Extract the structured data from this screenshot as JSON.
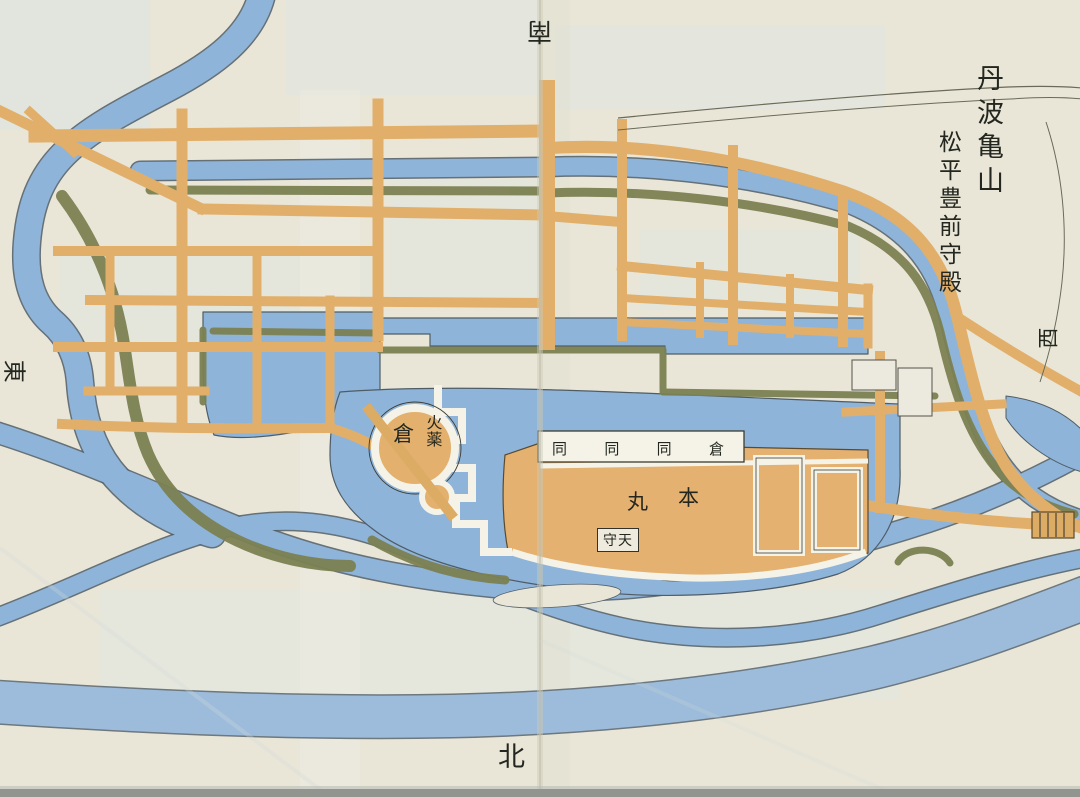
{
  "labels": {
    "title_castle": "丹波亀山",
    "title_lord": "松平豊前守殿",
    "compass_top": "南",
    "compass_bottom": "北",
    "compass_left": "東",
    "compass_right": "西",
    "gunpowder": "火薬",
    "gunpowder_store": "倉",
    "store_row": [
      "同",
      "同",
      "同",
      "倉"
    ],
    "honmaru_char_left": "丸",
    "honmaru_char_right": "本",
    "tenshu": "守天"
  },
  "colors": {
    "paper": "#e9e6d8",
    "water_blue": "#8fb4d9",
    "water_edge_ink": "#4f5c66",
    "road_orange": "#e1af6a",
    "honmaru_orange": "#e5b170",
    "embankment_olive": "#7c8152",
    "wall_white": "#f5f3e8",
    "text_ink": "#23271f"
  }
}
